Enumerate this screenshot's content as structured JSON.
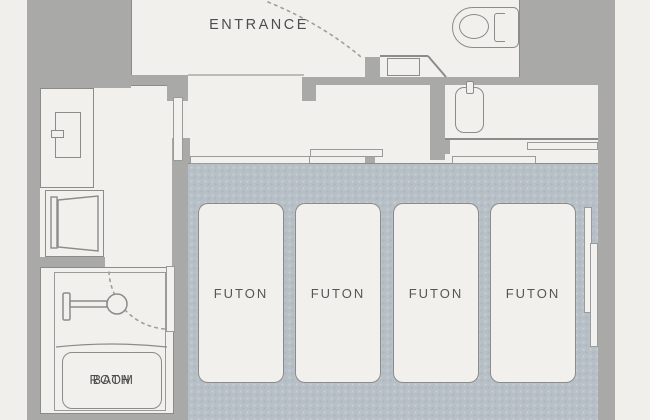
{
  "title": "hotel room floor plan",
  "labels": {
    "entrance": "ENTRANCE",
    "bath_line1": "BATH",
    "bath_line2": "ROOM"
  },
  "futons": [
    {
      "label": "FUTON"
    },
    {
      "label": "FUTON"
    },
    {
      "label": "FUTON"
    },
    {
      "label": "FUTON"
    }
  ],
  "rooms": [
    "entrance",
    "corridor",
    "hallway",
    "washbasin-area",
    "toilet-area",
    "bathroom",
    "tatami-room"
  ],
  "icons": [
    "toilet-icon",
    "washbasin-icon",
    "refrigerator-icon",
    "washing-machine-icon",
    "shower-icon",
    "bathtub-icon",
    "sliding-window-icon",
    "sliding-door-icon",
    "door-swing-arc-icon",
    "shoe-cabinet-icon",
    "fusuma-panel-icon"
  ],
  "colors": {
    "bg": "#f1efec",
    "floor": "#f2f0ed",
    "floor2": "#f3f1ee",
    "wall": "#a9a9a7",
    "line": "#8b8b89",
    "line2": "#9a9a98",
    "tatami": "#b8c0c7",
    "text": "#4e4e4c",
    "step": "#bdbbb7"
  }
}
